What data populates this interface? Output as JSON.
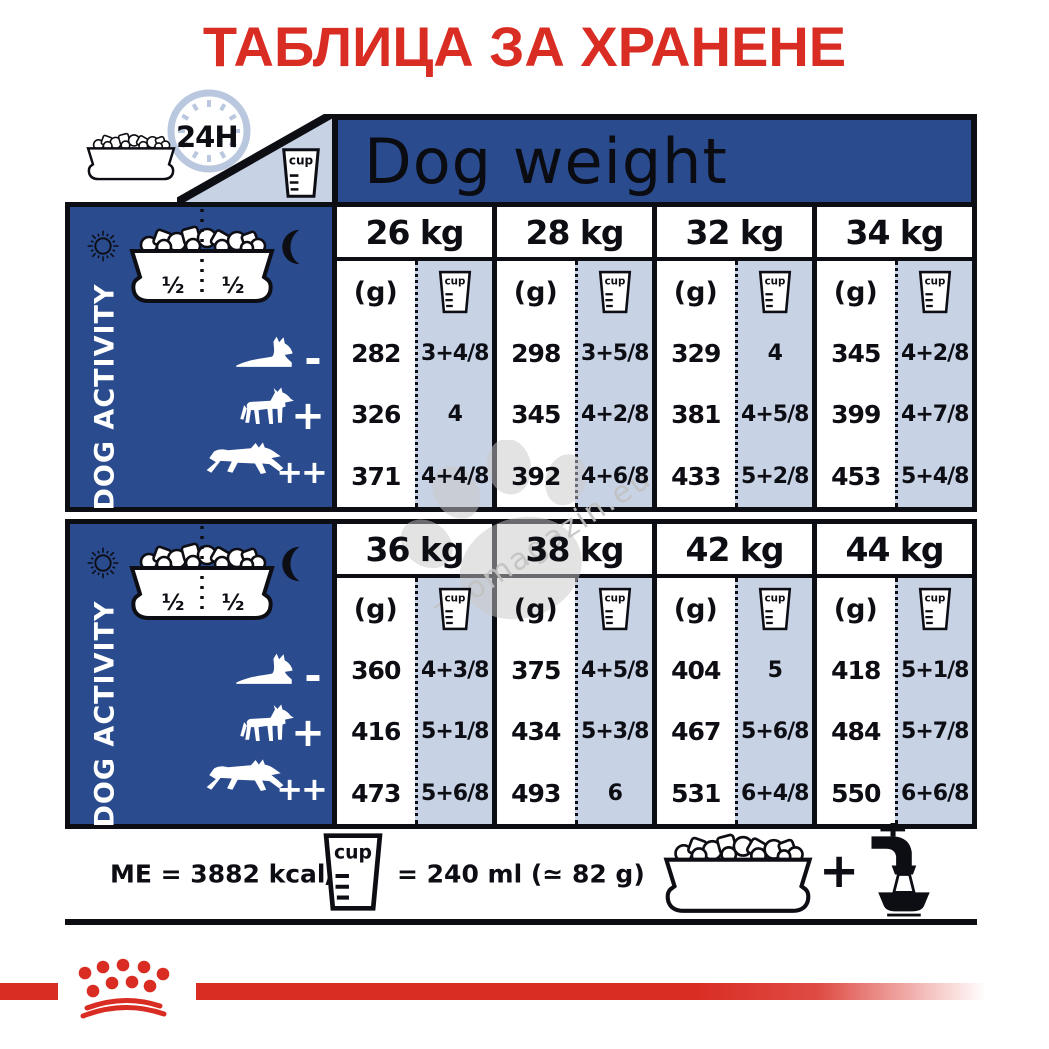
{
  "title": "ТАБЛИЦА ЗА ХРАНЕНЕ",
  "header": {
    "h24": "24H",
    "dog_weight_label": "Dog weight"
  },
  "sidebar": {
    "activity_label": "DOG ACTIVITY",
    "bowl_half_left": "½",
    "bowl_half_right": "½",
    "levels": [
      {
        "name": "low-activity",
        "symbol": "-"
      },
      {
        "name": "normal-activity",
        "symbol": "+"
      },
      {
        "name": "high-activity",
        "symbol": "++"
      }
    ]
  },
  "table": {
    "unit_gram_label": "(g)",
    "cup_label": "cup",
    "sections": [
      {
        "columns": [
          {
            "weight": "26 kg",
            "rows": [
              {
                "g": "282",
                "cup": "3+4/8"
              },
              {
                "g": "326",
                "cup": "4"
              },
              {
                "g": "371",
                "cup": "4+4/8"
              }
            ]
          },
          {
            "weight": "28 kg",
            "rows": [
              {
                "g": "298",
                "cup": "3+5/8"
              },
              {
                "g": "345",
                "cup": "4+2/8"
              },
              {
                "g": "392",
                "cup": "4+6/8"
              }
            ]
          },
          {
            "weight": "32 kg",
            "rows": [
              {
                "g": "329",
                "cup": "4"
              },
              {
                "g": "381",
                "cup": "4+5/8"
              },
              {
                "g": "433",
                "cup": "5+2/8"
              }
            ]
          },
          {
            "weight": "34 kg",
            "rows": [
              {
                "g": "345",
                "cup": "4+2/8"
              },
              {
                "g": "399",
                "cup": "4+7/8"
              },
              {
                "g": "453",
                "cup": "5+4/8"
              }
            ]
          }
        ]
      },
      {
        "columns": [
          {
            "weight": "36 kg",
            "rows": [
              {
                "g": "360",
                "cup": "4+3/8"
              },
              {
                "g": "416",
                "cup": "5+1/8"
              },
              {
                "g": "473",
                "cup": "5+6/8"
              }
            ]
          },
          {
            "weight": "38 kg",
            "rows": [
              {
                "g": "375",
                "cup": "4+5/8"
              },
              {
                "g": "434",
                "cup": "5+3/8"
              },
              {
                "g": "493",
                "cup": "6"
              }
            ]
          },
          {
            "weight": "42 kg",
            "rows": [
              {
                "g": "404",
                "cup": "5"
              },
              {
                "g": "467",
                "cup": "5+6/8"
              },
              {
                "g": "531",
                "cup": "6+4/8"
              }
            ]
          },
          {
            "weight": "44 kg",
            "rows": [
              {
                "g": "418",
                "cup": "5+1/8"
              },
              {
                "g": "484",
                "cup": "5+7/8"
              },
              {
                "g": "550",
                "cup": "6+6/8"
              }
            ]
          }
        ]
      }
    ]
  },
  "footer": {
    "me_label": "ME = 3882 kcal/kg",
    "equiv_label": "= 240 ml (≃ 82 g)",
    "plus_sign": "+"
  },
  "watermark": {
    "text": "zoomagazin.eu"
  },
  "colors": {
    "red": "#d92c23",
    "dark_blue": "#2a4b8e",
    "light_blue": "#c7d2e5"
  }
}
